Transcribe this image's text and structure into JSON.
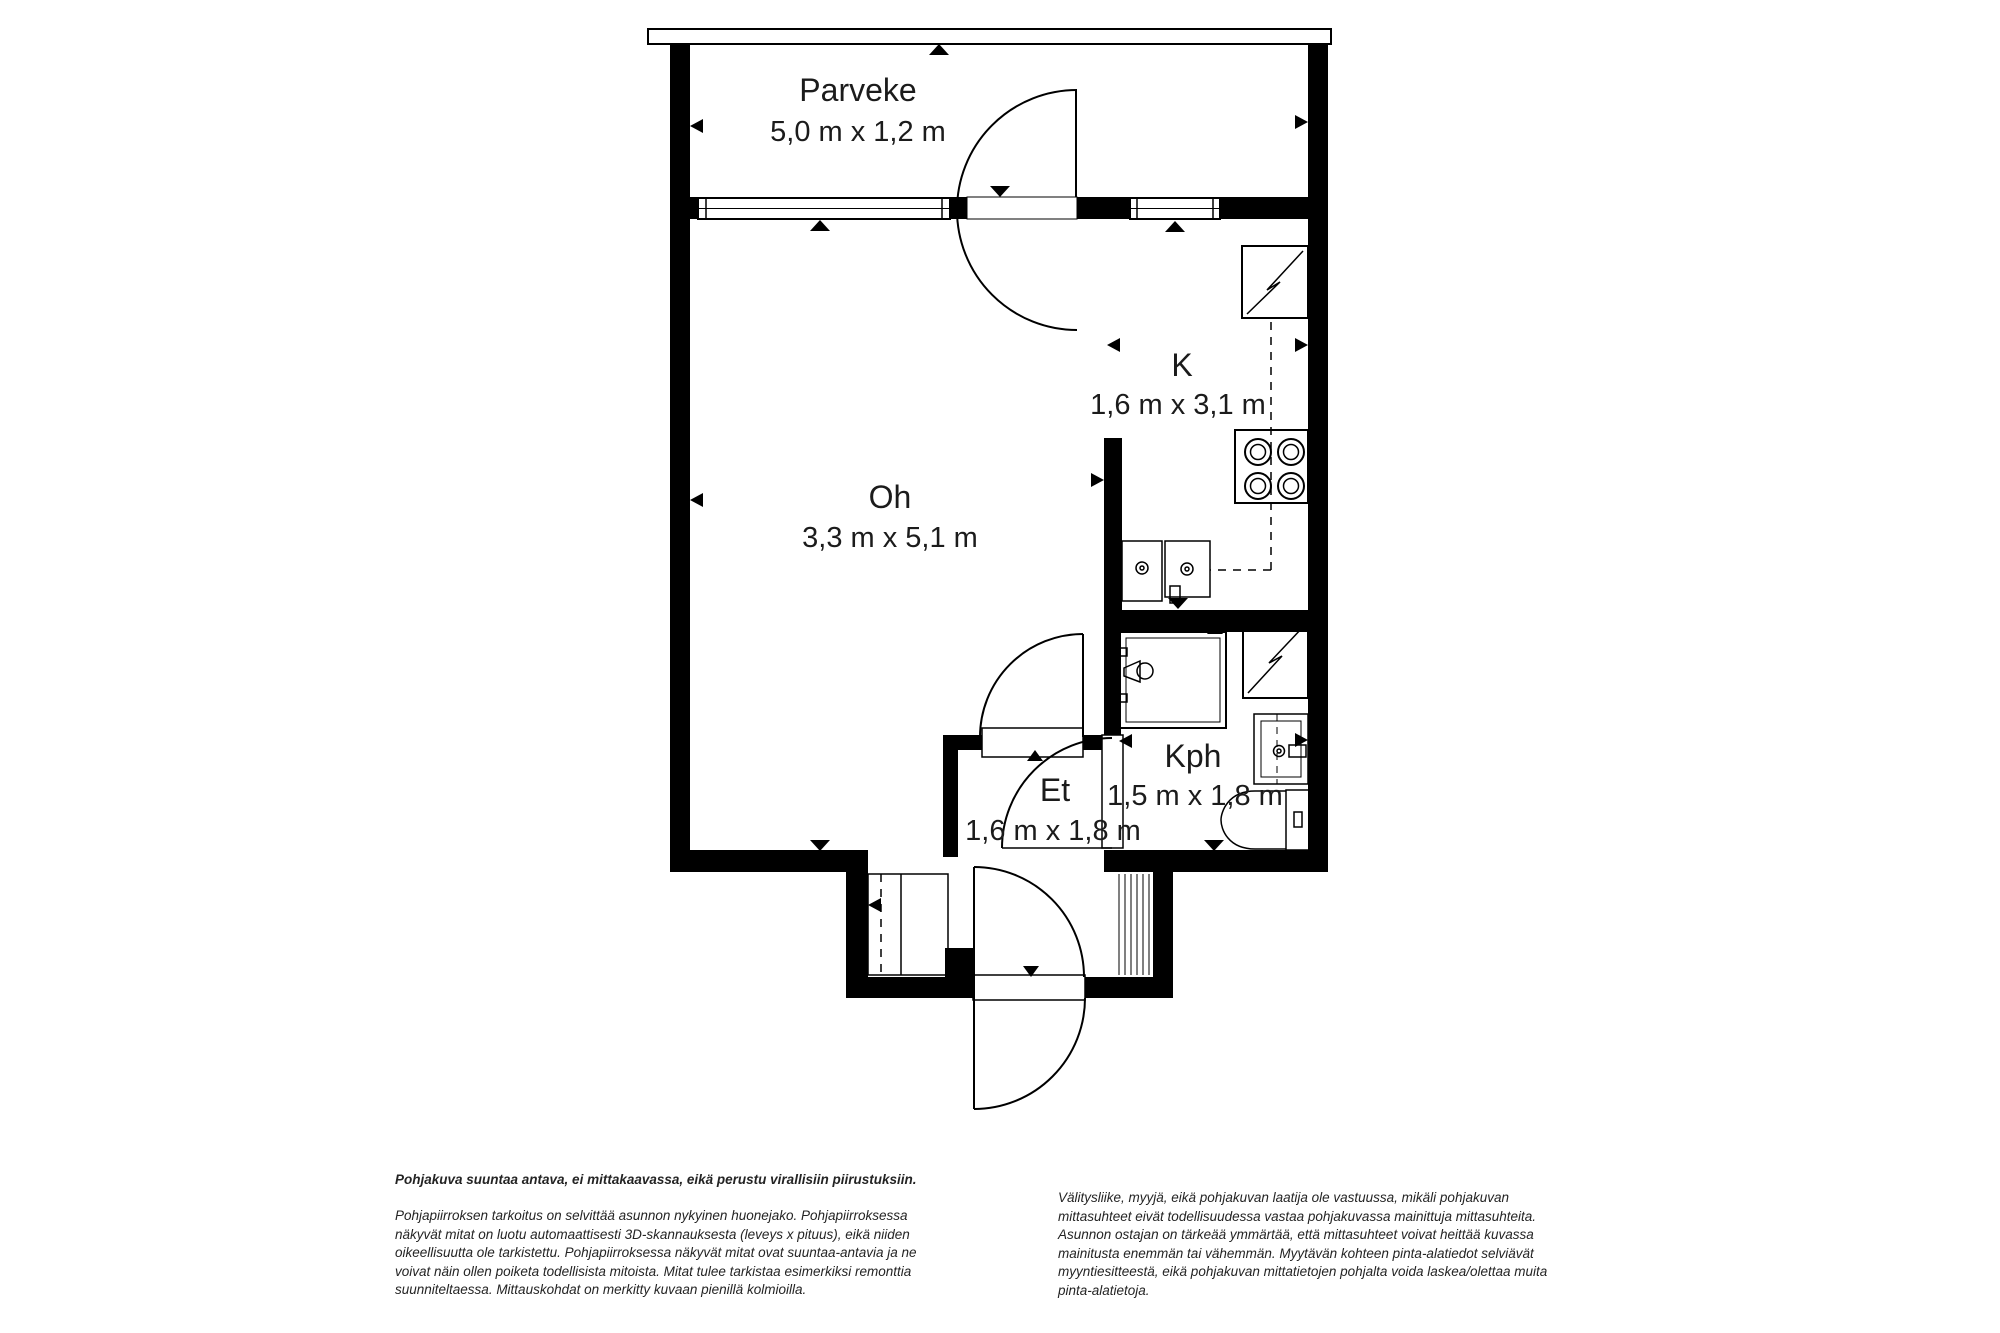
{
  "floorplan": {
    "rooms": [
      {
        "id": "parveke",
        "label": "Parveke",
        "dimensions": "5,0 m x 1,2 m"
      },
      {
        "id": "oh",
        "label": "Oh",
        "dimensions": "3,3 m x 5,1 m"
      },
      {
        "id": "k",
        "label": "K",
        "dimensions": "1,6 m x 3,1 m"
      },
      {
        "id": "et",
        "label": "Et",
        "dimensions": "1,6 m x 1,8 m"
      },
      {
        "id": "kph",
        "label": "Kph",
        "dimensions": "1,5 m x 1,8 m"
      }
    ],
    "icons": [
      "window-icon",
      "balcony-door-icon",
      "living-room-door-icon",
      "bathroom-door-icon",
      "front-door-icon",
      "refrigerator-icon",
      "stove-icon",
      "kitchen-sink-icon",
      "counter-edge-icon",
      "shower-icon",
      "water-heater-icon",
      "washbasin-icon",
      "toilet-icon",
      "wardrobe-icon",
      "stairs-hatch-icon",
      "measure-triangle-icon"
    ],
    "colors": {
      "wall": "#000000",
      "background": "#ffffff",
      "label_text": "#1b1b1b"
    }
  },
  "disclaimers": {
    "headline": "Pohjakuva suuntaa antava, ei mittakaavassa, eikä perustu virallisiin piirustuksiin.",
    "left_paragraph": "Pohjapiirroksen tarkoitus on selvittää asunnon nykyinen huonejako. Pohjapiirroksessa näkyvät mitat on luotu automaattisesti 3D-skannauksesta (leveys x pituus), eikä niiden oikeellisuutta ole tarkistettu. Pohjapiirroksessa näkyvät mitat ovat suuntaa-antavia ja ne voivat näin ollen poiketa todellisista mitoista. Mitat tulee tarkistaa esimerkiksi remonttia suunniteltaessa. Mittauskohdat on merkitty kuvaan pienillä kolmioilla.",
    "right_paragraph": "Välitysliike, myyjä, eikä pohjakuvan laatija ole vastuussa, mikäli pohjakuvan mittasuhteet eivät todellisuudessa vastaa pohjakuvassa mainittuja mittasuhteita. Asunnon ostajan on tärkeää ymmärtää, että mittasuhteet voivat heittää kuvassa mainitusta enemmän tai vähemmän. Myytävän kohteen pinta-alatiedot selviävät myyntiesitteestä, eikä pohjakuvan mittatietojen pohjalta voida laskea/olettaa muita pinta-alatietoja."
  }
}
